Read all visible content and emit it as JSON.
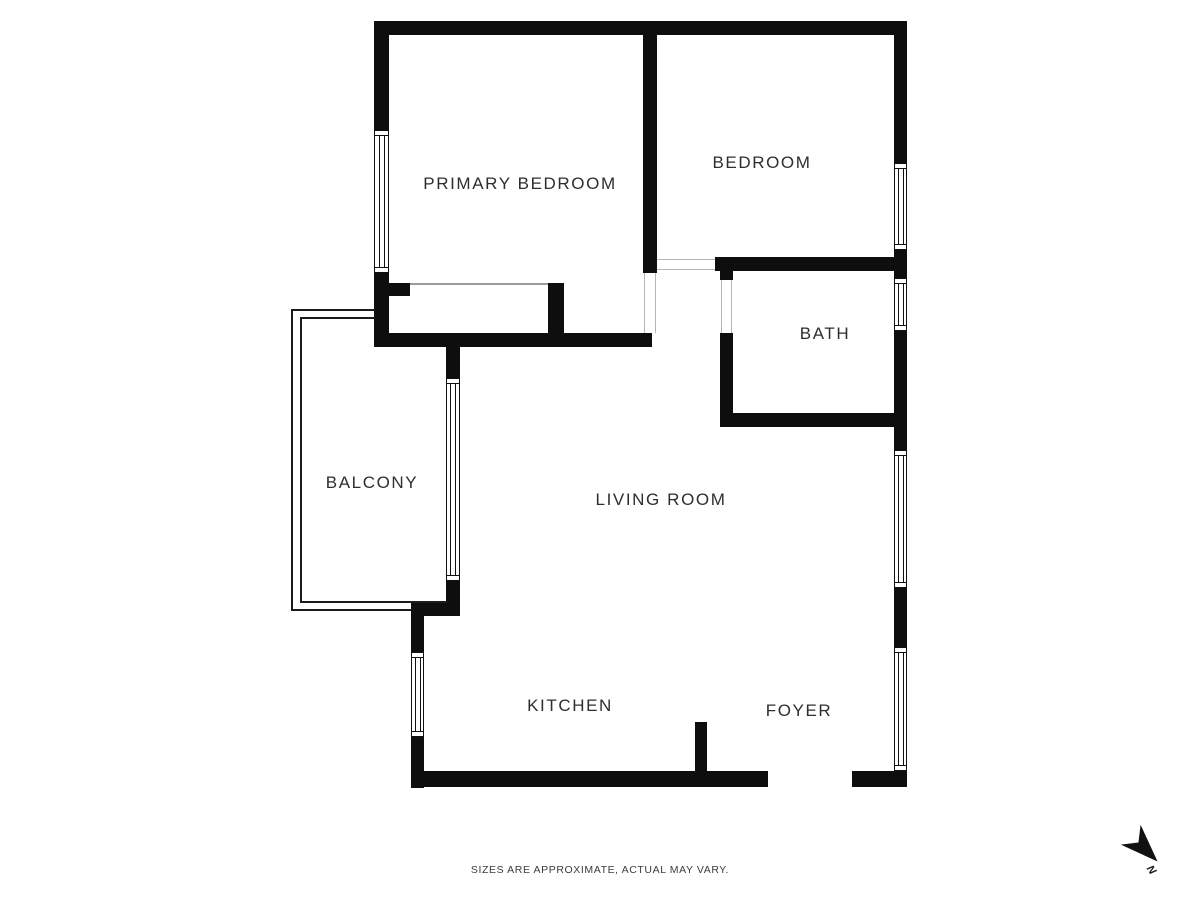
{
  "canvas": {
    "width": 1200,
    "height": 900,
    "background": "#ffffff"
  },
  "palette": {
    "wall": "#0e0e0e",
    "window_line": "#111111",
    "opening_line": "#b5b5b5",
    "balcony_line": "#1c1c1c",
    "closet_line": "#9c9c9c",
    "label_color": "#2e2e2e",
    "disclaimer_color": "#3c3c3c"
  },
  "rooms": [
    {
      "id": "primary-bedroom",
      "label": "PRIMARY BEDROOM",
      "cx": 520,
      "cy": 184
    },
    {
      "id": "bedroom",
      "label": "BEDROOM",
      "cx": 762,
      "cy": 163
    },
    {
      "id": "bath",
      "label": "BATH",
      "cx": 825,
      "cy": 334
    },
    {
      "id": "balcony",
      "label": "BALCONY",
      "cx": 372,
      "cy": 483
    },
    {
      "id": "living-room",
      "label": "LIVING ROOM",
      "cx": 661,
      "cy": 500
    },
    {
      "id": "kitchen",
      "label": "KITCHEN",
      "cx": 570,
      "cy": 706
    },
    {
      "id": "foyer",
      "label": "FOYER",
      "cx": 799,
      "cy": 711
    }
  ],
  "walls": [
    {
      "id": "top-wall",
      "x": 374,
      "y": 21,
      "w": 533,
      "h": 14
    },
    {
      "id": "right-wall-seg1",
      "x": 894,
      "y": 21,
      "w": 13,
      "h": 142
    },
    {
      "id": "right-wall-seg2",
      "x": 894,
      "y": 250,
      "w": 13,
      "h": 28
    },
    {
      "id": "right-wall-seg3",
      "x": 894,
      "y": 331,
      "w": 13,
      "h": 119
    },
    {
      "id": "right-wall-seg4",
      "x": 894,
      "y": 588,
      "w": 13,
      "h": 59
    },
    {
      "id": "right-wall-seg5",
      "x": 894,
      "y": 771,
      "w": 13,
      "h": 16
    },
    {
      "id": "left-wall-seg1",
      "x": 374,
      "y": 21,
      "w": 15,
      "h": 109
    },
    {
      "id": "left-wall-seg2",
      "x": 374,
      "y": 273,
      "w": 15,
      "h": 74
    },
    {
      "id": "corridor-bottom-wall",
      "x": 374,
      "y": 333,
      "w": 278,
      "h": 14
    },
    {
      "id": "closet-left-nib",
      "x": 389,
      "y": 283,
      "w": 21,
      "h": 13
    },
    {
      "id": "closet-right-wall",
      "x": 548,
      "y": 283,
      "w": 16,
      "h": 52
    },
    {
      "id": "bedroom-divider-wall",
      "x": 643,
      "y": 34,
      "w": 14,
      "h": 239
    },
    {
      "id": "bedroom-bottom-wall",
      "x": 715,
      "y": 257,
      "w": 179,
      "h": 14
    },
    {
      "id": "bath-left-wall-stub",
      "x": 720,
      "y": 271,
      "w": 13,
      "h": 9
    },
    {
      "id": "bath-left-wall",
      "x": 720,
      "y": 333,
      "w": 13,
      "h": 94
    },
    {
      "id": "bath-bottom-wall",
      "x": 720,
      "y": 413,
      "w": 174,
      "h": 14
    },
    {
      "id": "balcony-door-top-stub",
      "x": 446,
      "y": 347,
      "w": 14,
      "h": 31
    },
    {
      "id": "balcony-door-bottom-stub",
      "x": 446,
      "y": 581,
      "w": 14,
      "h": 22
    },
    {
      "id": "kitchen-corner-wall",
      "x": 411,
      "y": 603,
      "w": 49,
      "h": 13
    },
    {
      "id": "kitchen-left-wall-seg1",
      "x": 411,
      "y": 616,
      "w": 13,
      "h": 36
    },
    {
      "id": "kitchen-left-wall-seg2",
      "x": 411,
      "y": 737,
      "w": 13,
      "h": 51
    },
    {
      "id": "bottom-wall-left",
      "x": 411,
      "y": 771,
      "w": 357,
      "h": 16
    },
    {
      "id": "bottom-wall-right",
      "x": 852,
      "y": 771,
      "w": 55,
      "h": 16
    },
    {
      "id": "kitchen-foyer-divider",
      "x": 695,
      "y": 722,
      "w": 12,
      "h": 49
    }
  ],
  "windows": [
    {
      "id": "bedroom-window",
      "x": 894,
      "y": 163,
      "w": 13,
      "h": 87
    },
    {
      "id": "bath-window",
      "x": 894,
      "y": 278,
      "w": 13,
      "h": 53
    },
    {
      "id": "living-room-window",
      "x": 894,
      "y": 450,
      "w": 13,
      "h": 138
    },
    {
      "id": "foyer-window",
      "x": 894,
      "y": 647,
      "w": 13,
      "h": 124
    },
    {
      "id": "primary-bedroom-window",
      "x": 374,
      "y": 130,
      "w": 15,
      "h": 143
    },
    {
      "id": "kitchen-window",
      "x": 411,
      "y": 652,
      "w": 13,
      "h": 85
    },
    {
      "id": "balcony-sliding-door",
      "x": 446,
      "y": 378,
      "w": 14,
      "h": 203
    }
  ],
  "openings": [
    {
      "id": "primary-bedroom-door",
      "x": 643,
      "y": 273,
      "w": 14,
      "h": 60,
      "dir": "v",
      "lines": true
    },
    {
      "id": "bedroom-door",
      "x": 657,
      "y": 257,
      "w": 58,
      "h": 14,
      "dir": "h",
      "lines": true
    },
    {
      "id": "bath-door",
      "x": 720,
      "y": 280,
      "w": 13,
      "h": 53,
      "dir": "v",
      "lines": true
    },
    {
      "id": "entry-door",
      "x": 768,
      "y": 771,
      "w": 84,
      "h": 16,
      "dir": "h",
      "lines": false
    }
  ],
  "thin_lines": [
    {
      "id": "balcony-outer-top",
      "x": 291,
      "y": 309,
      "w": 84,
      "h": 2,
      "color": "#1c1c1c"
    },
    {
      "id": "balcony-outer-left",
      "x": 291,
      "y": 309,
      "w": 2,
      "h": 302,
      "color": "#1c1c1c"
    },
    {
      "id": "balcony-outer-bottom",
      "x": 291,
      "y": 609,
      "w": 121,
      "h": 2,
      "color": "#1c1c1c"
    },
    {
      "id": "balcony-inner-top",
      "x": 300,
      "y": 317,
      "w": 75,
      "h": 2,
      "color": "#1c1c1c"
    },
    {
      "id": "balcony-inner-left",
      "x": 300,
      "y": 317,
      "w": 2,
      "h": 286,
      "color": "#1c1c1c"
    },
    {
      "id": "balcony-inner-bottom",
      "x": 300,
      "y": 601,
      "w": 147,
      "h": 2,
      "color": "#1c1c1c"
    },
    {
      "id": "closet-front-line",
      "x": 410,
      "y": 283,
      "w": 138,
      "h": 2,
      "color": "#9c9c9c"
    }
  ],
  "disclaimer": {
    "text": "SIZES ARE APPROXIMATE, ACTUAL MAY VARY.",
    "cx": 600,
    "cy": 870
  },
  "north_arrow": {
    "label": "N",
    "x": 1118,
    "y": 824,
    "rotation_deg": 135
  }
}
